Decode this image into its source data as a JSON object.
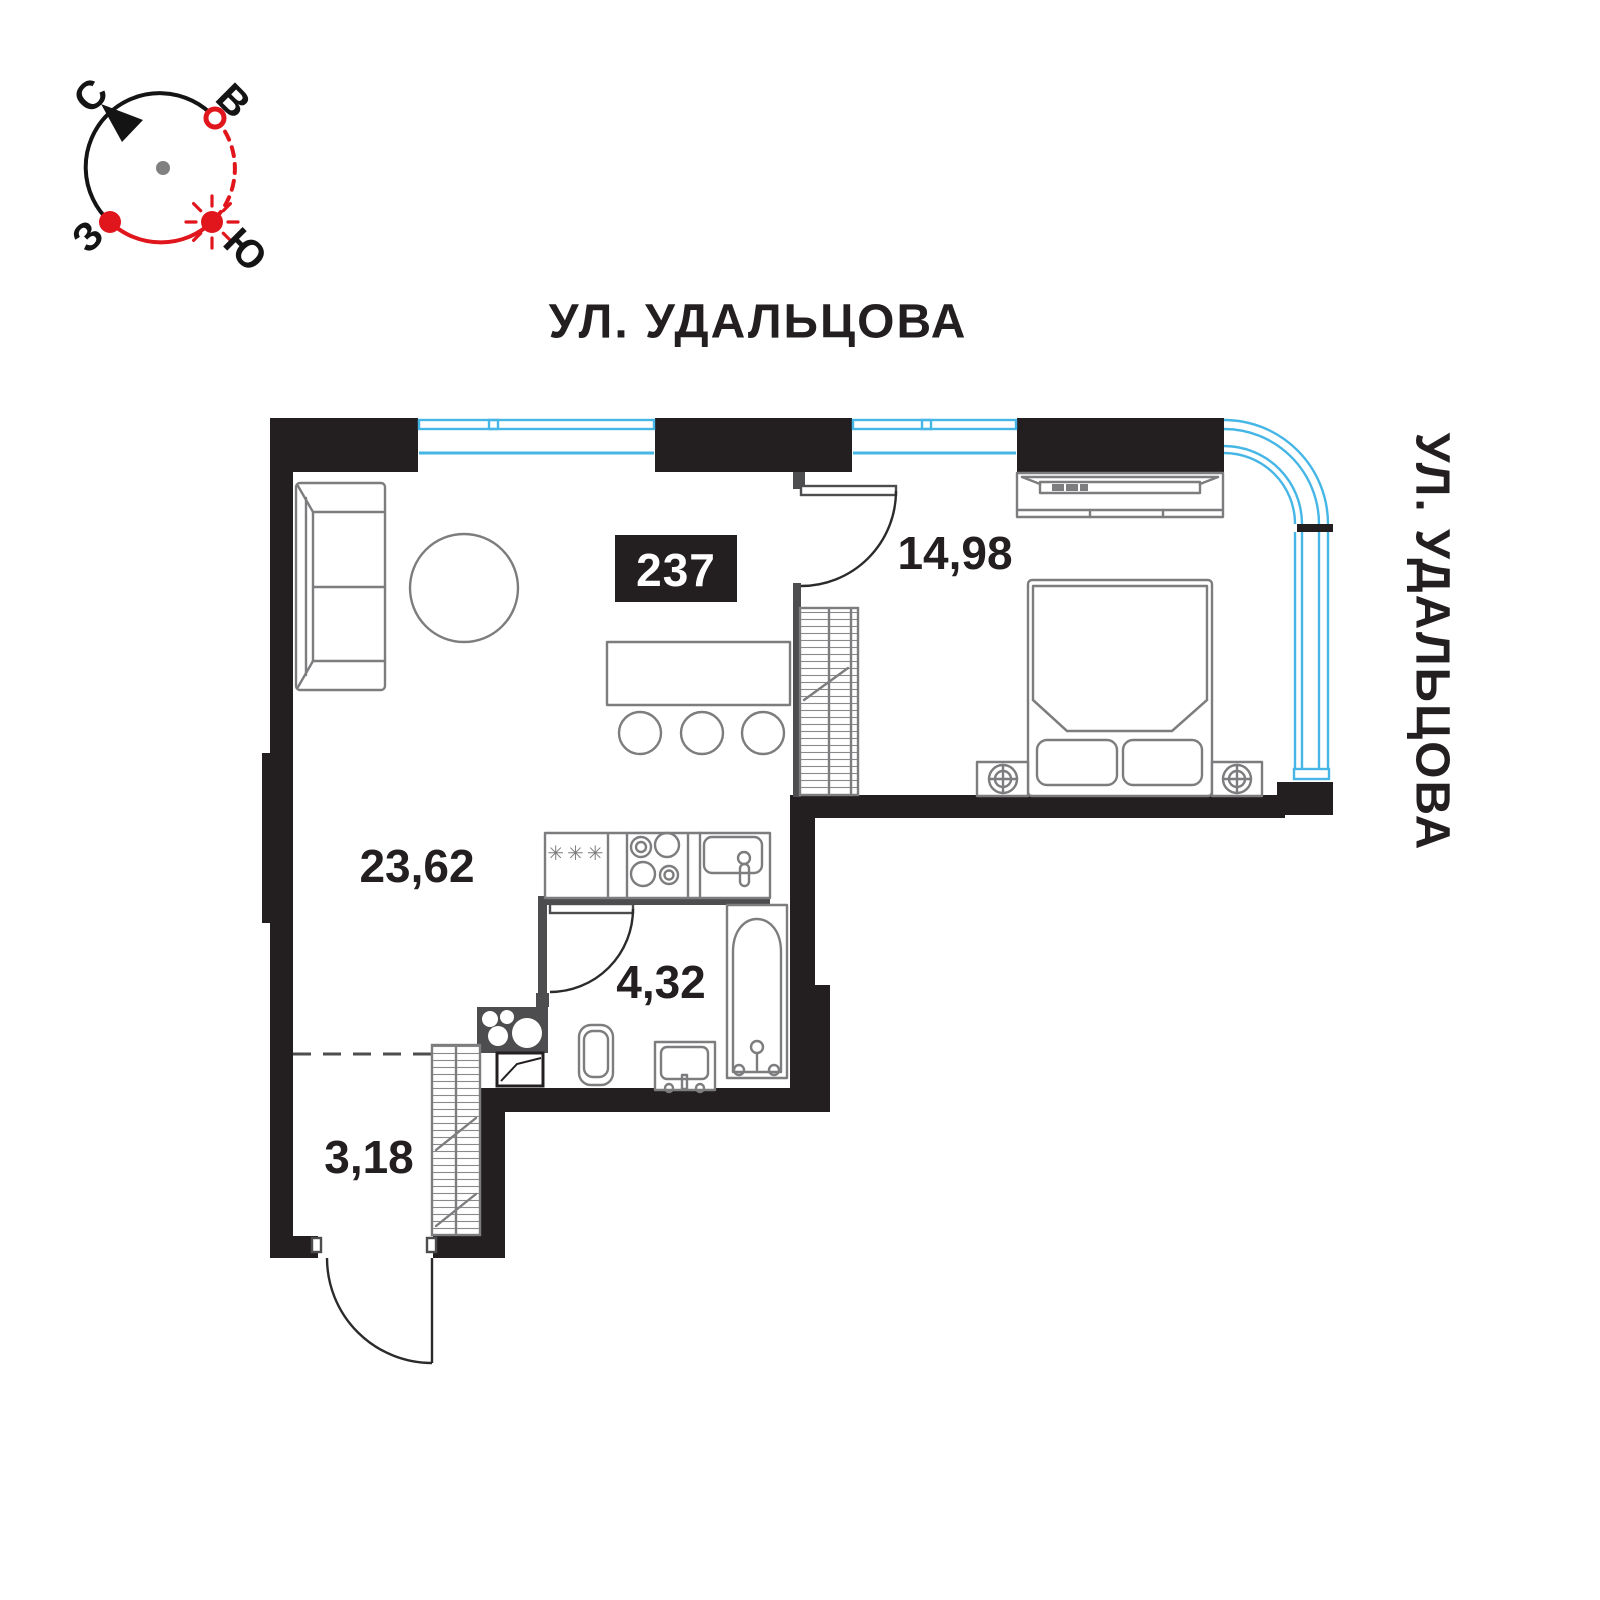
{
  "compass": {
    "labels": {
      "north": "С",
      "east": "В",
      "west": "З",
      "south": "Ю"
    }
  },
  "streets": {
    "top_label": "УЛ. УДАЛЬЦОВА",
    "right_label": "УЛ. УДАЛЬЦОВА"
  },
  "apartment": {
    "number": "237"
  },
  "rooms": {
    "living": {
      "area": "23,62"
    },
    "bedroom": {
      "area": "14,98"
    },
    "bathroom": {
      "area": "4,32"
    },
    "hallway": {
      "area": "3,18"
    }
  },
  "icons": {
    "freezer_symbols": "✳✳✳"
  },
  "colors": {
    "wall": "#231f20",
    "dim": "#4d4d4f",
    "furniture": "#7d7d7f",
    "window": "#45b6e6",
    "accent_red": "#e0161c",
    "badge_text": "#ffffff"
  }
}
